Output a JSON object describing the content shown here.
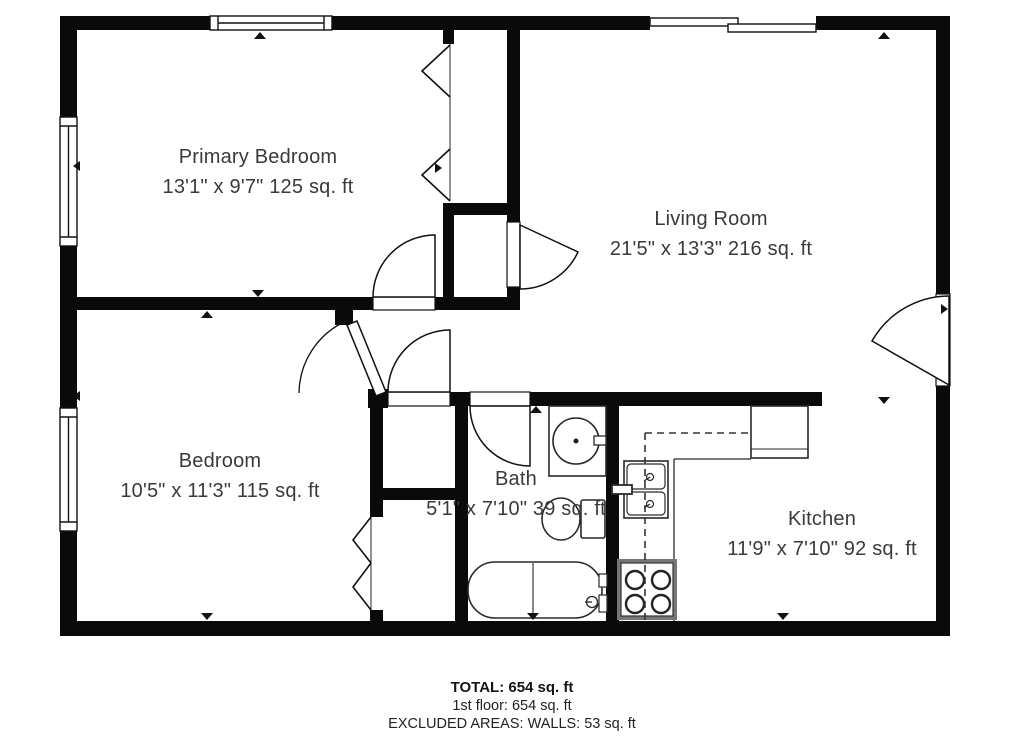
{
  "title": "2-bedroom floor plan",
  "rooms": {
    "primary_bedroom": {
      "name": "Primary Bedroom",
      "dims": "13'1\" x 9'7\" 125 sq. ft"
    },
    "living_room": {
      "name": "Living Room",
      "dims": "21'5\" x 13'3\" 216 sq. ft"
    },
    "bedroom": {
      "name": "Bedroom",
      "dims": "10'5\" x 11'3\" 115 sq. ft"
    },
    "bath": {
      "name": "Bath",
      "dims": "5'1\" x 7'10\" 39 sq. ft"
    },
    "kitchen": {
      "name": "Kitchen",
      "dims": "11'9\" x 7'10\" 92 sq. ft"
    }
  },
  "footer": {
    "total": "TOTAL: 654 sq. ft",
    "first_floor": "1st floor: 654 sq. ft",
    "excluded": "EXCLUDED AREAS: WALLS: 53 sq. ft"
  },
  "colors": {
    "wall": "#0a0a0a",
    "label_text": "#3a3a3a",
    "footer_text": "#141414"
  }
}
